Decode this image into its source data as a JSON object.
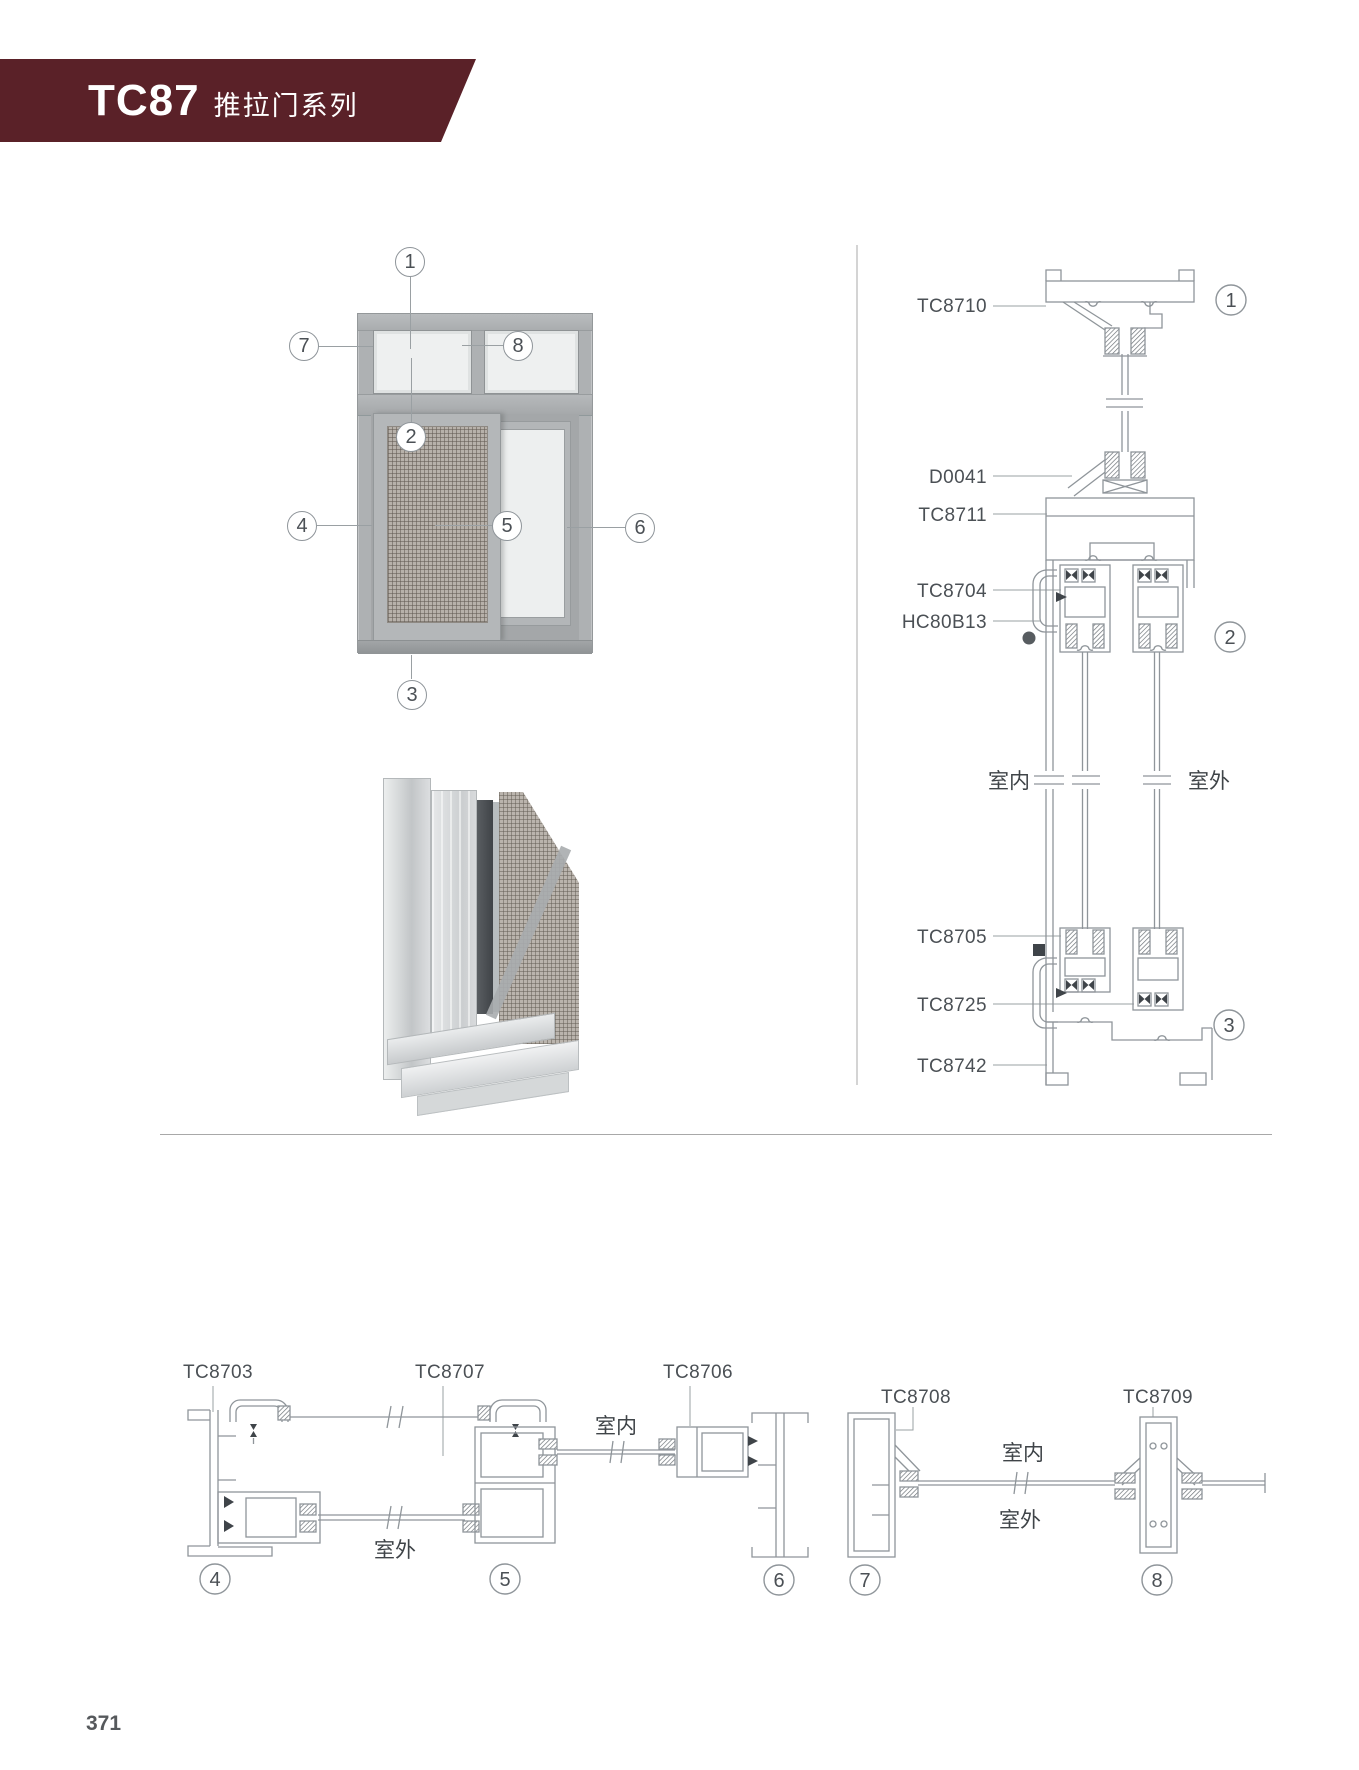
{
  "header": {
    "code": "TC87",
    "series": "推拉门系列",
    "banner_color": "#5a2128",
    "text_color": "#ffffff"
  },
  "page": {
    "number": "371"
  },
  "colors": {
    "line": "#8f959a",
    "label": "#4b5055",
    "dark_seal": "#3f4449",
    "frame_gray": "#aeb1b3",
    "glass_gray": "#eef0f0"
  },
  "elevation": {
    "callouts": {
      "c1": "1",
      "c2": "2",
      "c3": "3",
      "c4": "4",
      "c5": "5",
      "c6": "6",
      "c7": "7",
      "c8": "8"
    }
  },
  "vertical_section": {
    "labels": {
      "top_frame": "TC8710",
      "connector": "D0041",
      "transom": "TC8711",
      "sash_top": "TC8704",
      "handle": "HC80B13",
      "sash_bottom": "TC8705",
      "hook_bottom": "TC8725",
      "track": "TC8742"
    },
    "indoor": "室内",
    "outdoor": "室外",
    "callouts": {
      "c1": "1",
      "c2": "2",
      "c3": "3"
    }
  },
  "bottom_section": {
    "labels": {
      "jamb_left": "TC8703",
      "sash": "TC8707",
      "interlock": "TC8706",
      "jamb_right": "TC8708",
      "meeting_stile": "TC8709"
    },
    "left_outdoor": "室外",
    "mid_indoor": "室内",
    "right_indoor": "室内",
    "right_outdoor": "室外",
    "callouts": {
      "c4": "4",
      "c5": "5",
      "c6": "6",
      "c7": "7",
      "c8": "8"
    }
  }
}
